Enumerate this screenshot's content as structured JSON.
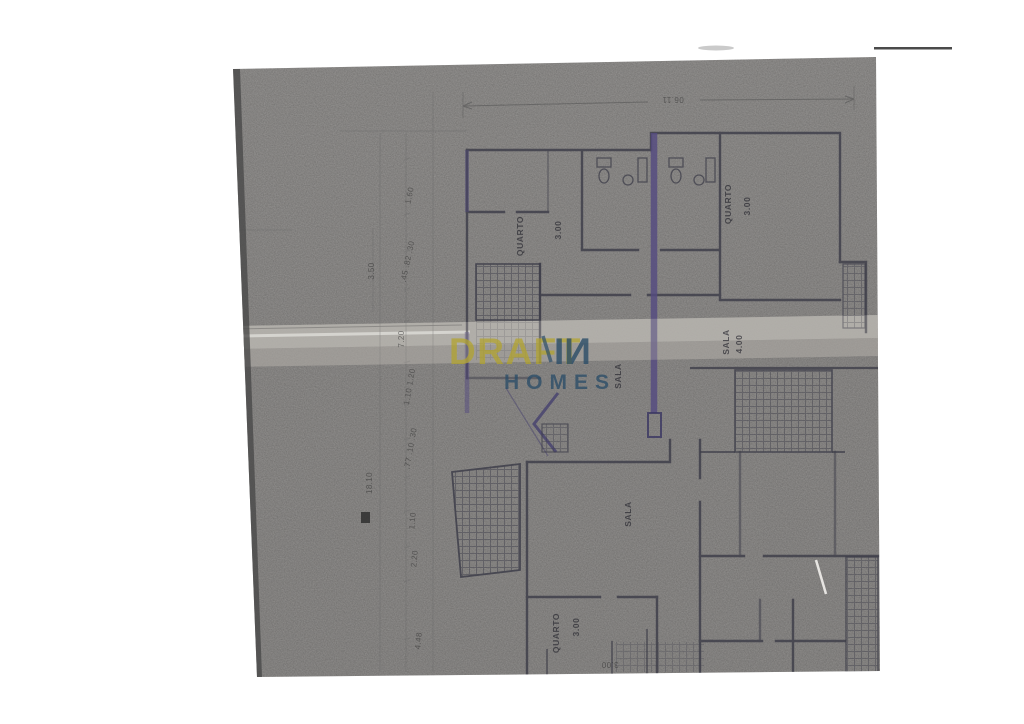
{
  "document": {
    "type": "scanned-floor-plan",
    "description": "Grayscale scan of an architectural floor plan, rotated upside down, with watermark"
  },
  "watermark": {
    "draft": "DRAFT",
    "in": "IИ",
    "homes": "HOMES",
    "draft_color": "#b3a42c",
    "navy_color": "#2b4d68"
  },
  "colors": {
    "paper": "#8f8d8b",
    "ink": "#3d3d49",
    "highlight_purple": "#544a80",
    "crease": "#b9b6b1",
    "page_background": "#ffffff"
  },
  "room_labels": [
    {
      "text": "QUARTO"
    },
    {
      "text": "3.00"
    },
    {
      "text": "QUARTO"
    },
    {
      "text": "3.00"
    },
    {
      "text": "SALA"
    },
    {
      "text": "SALA"
    },
    {
      "text": "4.00"
    },
    {
      "text": "SALA"
    },
    {
      "text": "QUARTO"
    },
    {
      "text": "3.00"
    }
  ],
  "dimensions": [
    {
      "text": "06.11"
    },
    {
      "text": "1.60"
    },
    {
      "text": "3.50"
    },
    {
      "text": ".45 .82 .30"
    },
    {
      "text": "7.20"
    },
    {
      "text": "1.10 1.20"
    },
    {
      "text": "18.10"
    },
    {
      "text": ".77 .10 .30"
    },
    {
      "text": "1.10"
    },
    {
      "text": "2.20"
    },
    {
      "text": "4.48"
    },
    {
      "text": "3.00"
    }
  ]
}
